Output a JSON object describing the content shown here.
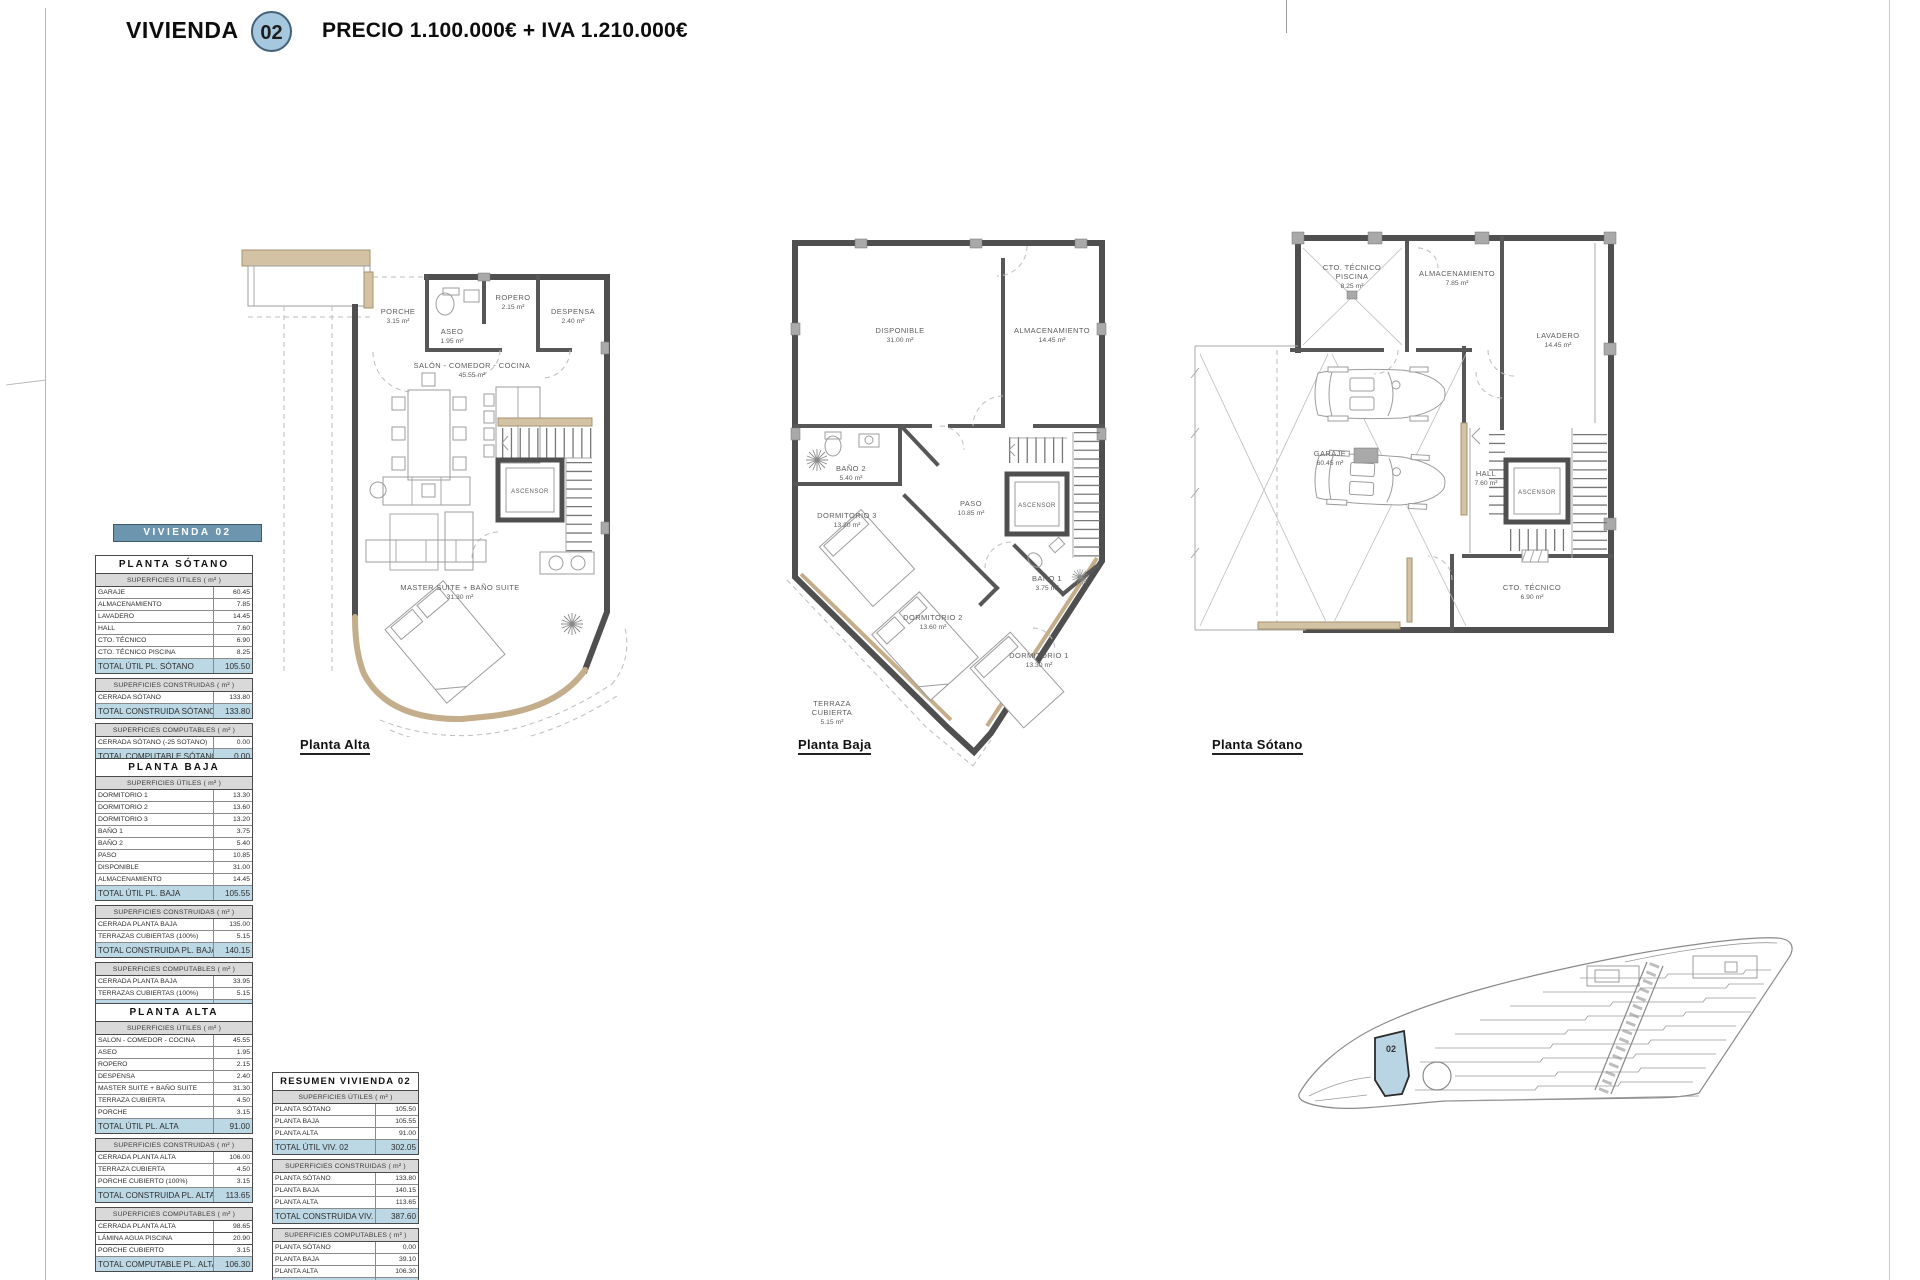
{
  "sheet": {
    "title_label": "VIVIENDA",
    "unit_number": "02",
    "price_line": "PRECIO 1.100.000€ + IVA 1.210.000€"
  },
  "summary_band": "VIVIENDA 02",
  "plan_captions": {
    "alta": "Planta Alta",
    "baja": "Planta Baja",
    "sotano": "Planta Sótano"
  },
  "plans": {
    "alta": {
      "rooms": {
        "porche": {
          "name": "PORCHE",
          "area": "3.15 m²"
        },
        "aseo": {
          "name": "ASEO",
          "area": "1.95 m²"
        },
        "ropero": {
          "name": "ROPERO",
          "area": "2.15 m²"
        },
        "despensa": {
          "name": "DESPENSA",
          "area": "2.40 m²"
        },
        "salon": {
          "name": "SALÓN - COMEDOR - COCINA",
          "area": "45.55 m²"
        },
        "ascensor": {
          "name": "ASCENSOR"
        },
        "master": {
          "name": "MASTER SUITE + BAÑO SUITE",
          "area": "31.30 m²"
        }
      }
    },
    "baja": {
      "rooms": {
        "disponible": {
          "name": "DISPONIBLE",
          "area": "31.00 m²"
        },
        "almacenamiento": {
          "name": "ALMACENAMIENTO",
          "area": "14.45 m²"
        },
        "bano2": {
          "name": "BAÑO 2",
          "area": "5.40 m²"
        },
        "paso": {
          "name": "PASO",
          "area": "10.85 m²"
        },
        "ascensor": {
          "name": "ASCENSOR"
        },
        "dormitorio3": {
          "name": "DORMITORIO 3",
          "area": "13.20 m²"
        },
        "bano1": {
          "name": "BAÑO 1",
          "area": "3.75 m²"
        },
        "dormitorio2": {
          "name": "DORMITORIO 2",
          "area": "13.60 m²"
        },
        "dormitorio1": {
          "name": "DORMITORIO 1",
          "area": "13.30 m²"
        },
        "terraza": {
          "name": "TERRAZA",
          "name2": "CUBIERTA",
          "area": "5.15 m²"
        }
      }
    },
    "sotano": {
      "rooms": {
        "cto_piscina": {
          "name": "CTO. TÉCNICO",
          "name2": "PISCINA",
          "area": "8.25 m²"
        },
        "almacenamiento": {
          "name": "ALMACENAMIENTO",
          "area": "7.85 m²"
        },
        "lavadero": {
          "name": "LAVADERO",
          "area": "14.45 m²"
        },
        "garaje": {
          "name": "GARAJE",
          "area": "60.45 m²"
        },
        "hall": {
          "name": "HALL",
          "area": "7.60 m²"
        },
        "ascensor": {
          "name": "ASCENSOR"
        },
        "cto_tecnico": {
          "name": "CTO. TÉCNICO",
          "area": "6.90 m²"
        }
      }
    }
  },
  "tables": {
    "planta_sotano": {
      "title": "PLANTA SÓTANO",
      "sections": [
        {
          "header": "SUPERFICIES ÚTILES ( m² )",
          "rows": [
            [
              "GARAJE",
              "60.45"
            ],
            [
              "ALMACENAMIENTO",
              "7.85"
            ],
            [
              "LAVADERO",
              "14.45"
            ],
            [
              "HALL",
              "7.60"
            ],
            [
              "CTO. TÉCNICO",
              "6.90"
            ],
            [
              "CTO. TÉCNICO PISCINA",
              "8.25"
            ]
          ],
          "total": [
            "TOTAL ÚTIL PL. SÓTANO",
            "105.50"
          ]
        },
        {
          "header": "SUPERFICIES CONSTRUIDAS ( m² )",
          "rows": [
            [
              "CERRADA SÓTANO",
              "133.80"
            ]
          ],
          "total": [
            "TOTAL CONSTRUIDA SÓTANO",
            "133.80"
          ]
        },
        {
          "header": "SUPERFICIES COMPUTABLES ( m² )",
          "rows": [
            [
              "CERRADA SÓTANO (-25 SOTANO)",
              "0.00"
            ]
          ],
          "total": [
            "TOTAL COMPUTABLE SÓTANO",
            "0.00"
          ]
        }
      ]
    },
    "planta_baja": {
      "title": "PLANTA BAJA",
      "sections": [
        {
          "header": "SUPERFICIES ÚTILES ( m² )",
          "rows": [
            [
              "DORMITORIO 1",
              "13.30"
            ],
            [
              "DORMITORIO 2",
              "13.60"
            ],
            [
              "DORMITORIO 3",
              "13.20"
            ],
            [
              "BAÑO 1",
              "3.75"
            ],
            [
              "BAÑO 2",
              "5.40"
            ],
            [
              "PASO",
              "10.85"
            ],
            [
              "DISPONIBLE",
              "31.00"
            ],
            [
              "ALMACENAMIENTO",
              "14.45"
            ]
          ],
          "total": [
            "TOTAL ÚTIL PL. BAJA",
            "105.55"
          ]
        },
        {
          "header": "SUPERFICIES CONSTRUIDAS ( m² )",
          "rows": [
            [
              "CERRADA PLANTA BAJA",
              "135.00"
            ],
            [
              "TERRAZAS CUBIERTAS (100%)",
              "5.15"
            ]
          ],
          "total": [
            "TOTAL CONSTRUIDA PL. BAJA",
            "140.15"
          ]
        },
        {
          "header": "SUPERFICIES COMPUTABLES ( m² )",
          "rows": [
            [
              "CERRADA PLANTA BAJA",
              "33.95"
            ],
            [
              "TERRAZAS CUBIERTAS (100%)",
              "5.15"
            ]
          ],
          "total": [
            "TOTAL COMPUTABLE PL. BAJA",
            "39.10"
          ]
        }
      ]
    },
    "planta_alta": {
      "title": "PLANTA ALTA",
      "sections": [
        {
          "header": "SUPERFICIES ÚTILES ( m² )",
          "rows": [
            [
              "SALON - COMEDOR - COCINA",
              "45.55"
            ],
            [
              "ASEO",
              "1.95"
            ],
            [
              "ROPERO",
              "2.15"
            ],
            [
              "DESPENSA",
              "2.40"
            ],
            [
              "MASTER SUITE + BAÑO SUITE",
              "31.30"
            ],
            [
              "TERRAZA CUBIERTA",
              "4.50"
            ],
            [
              "PORCHE",
              "3.15"
            ]
          ],
          "total": [
            "TOTAL ÚTIL PL. ALTA",
            "91.00"
          ]
        },
        {
          "header": "SUPERFICIES CONSTRUIDAS ( m² )",
          "rows": [
            [
              "CERRADA PLANTA ALTA",
              "106.00"
            ],
            [
              "TERRAZA CUBIERTA",
              "4.50"
            ],
            [
              "PORCHE CUBIERTO (100%)",
              "3.15"
            ]
          ],
          "total": [
            "TOTAL CONSTRUIDA PL. ALTA",
            "113.65"
          ]
        },
        {
          "header": "SUPERFICIES COMPUTABLES ( m² )",
          "rows": [
            [
              "CERRADA PLANTA ALTA",
              "98.65"
            ],
            [
              "TERRAZA CUBIERTA",
              "4.50"
            ],
            [
              "PORCHE CUBIERTO",
              "3.15"
            ]
          ],
          "total": [
            "TOTAL COMPUTABLE PL. ALTA",
            "106.30"
          ]
        }
      ]
    },
    "lamina": {
      "sections": [
        {
          "rows": [
            [
              "LÁMINA AGUA PISCINA",
              "20.90"
            ]
          ]
        }
      ]
    },
    "resumen": {
      "title": "RESUMEN VIVIENDA 02",
      "sections": [
        {
          "header": "SUPERFICIES ÚTILES ( m² )",
          "rows": [
            [
              "PLANTA SÓTANO",
              "105.50"
            ],
            [
              "PLANTA BAJA",
              "105.55"
            ],
            [
              "PLANTA ALTA",
              "91.00"
            ]
          ],
          "total": [
            "TOTAL ÚTIL VIV. 02",
            "302.05"
          ]
        },
        {
          "header": "SUPERFICIES CONSTRUIDAS ( m² )",
          "rows": [
            [
              "PLANTA SÓTANO",
              "133.80"
            ],
            [
              "PLANTA BAJA",
              "140.15"
            ],
            [
              "PLANTA ALTA",
              "113.65"
            ]
          ],
          "total": [
            "TOTAL CONSTRUIDA VIV. 02",
            "387.60"
          ]
        },
        {
          "header": "SUPERFICIES COMPUTABLES ( m² )",
          "rows": [
            [
              "PLANTA SÓTANO",
              "0.00"
            ],
            [
              "PLANTA BAJA",
              "39.10"
            ],
            [
              "PLANTA ALTA",
              "106.30"
            ]
          ],
          "total": [
            "TOTAL COMPUTABLE VIV. 02",
            "145.40"
          ]
        }
      ]
    }
  },
  "site_plan": {
    "highlighted_unit": "02"
  },
  "colors": {
    "unit_badge_blue": "#a5c8de",
    "band_blue": "#6d95ae",
    "total_row_blue": "#bcd8e4",
    "section_header_gray": "#d9d9d9",
    "wall_gray": "#4f4f4f",
    "wood_tan": "#d3c3a4",
    "site_highlight_blue": "#b9d4e3"
  }
}
